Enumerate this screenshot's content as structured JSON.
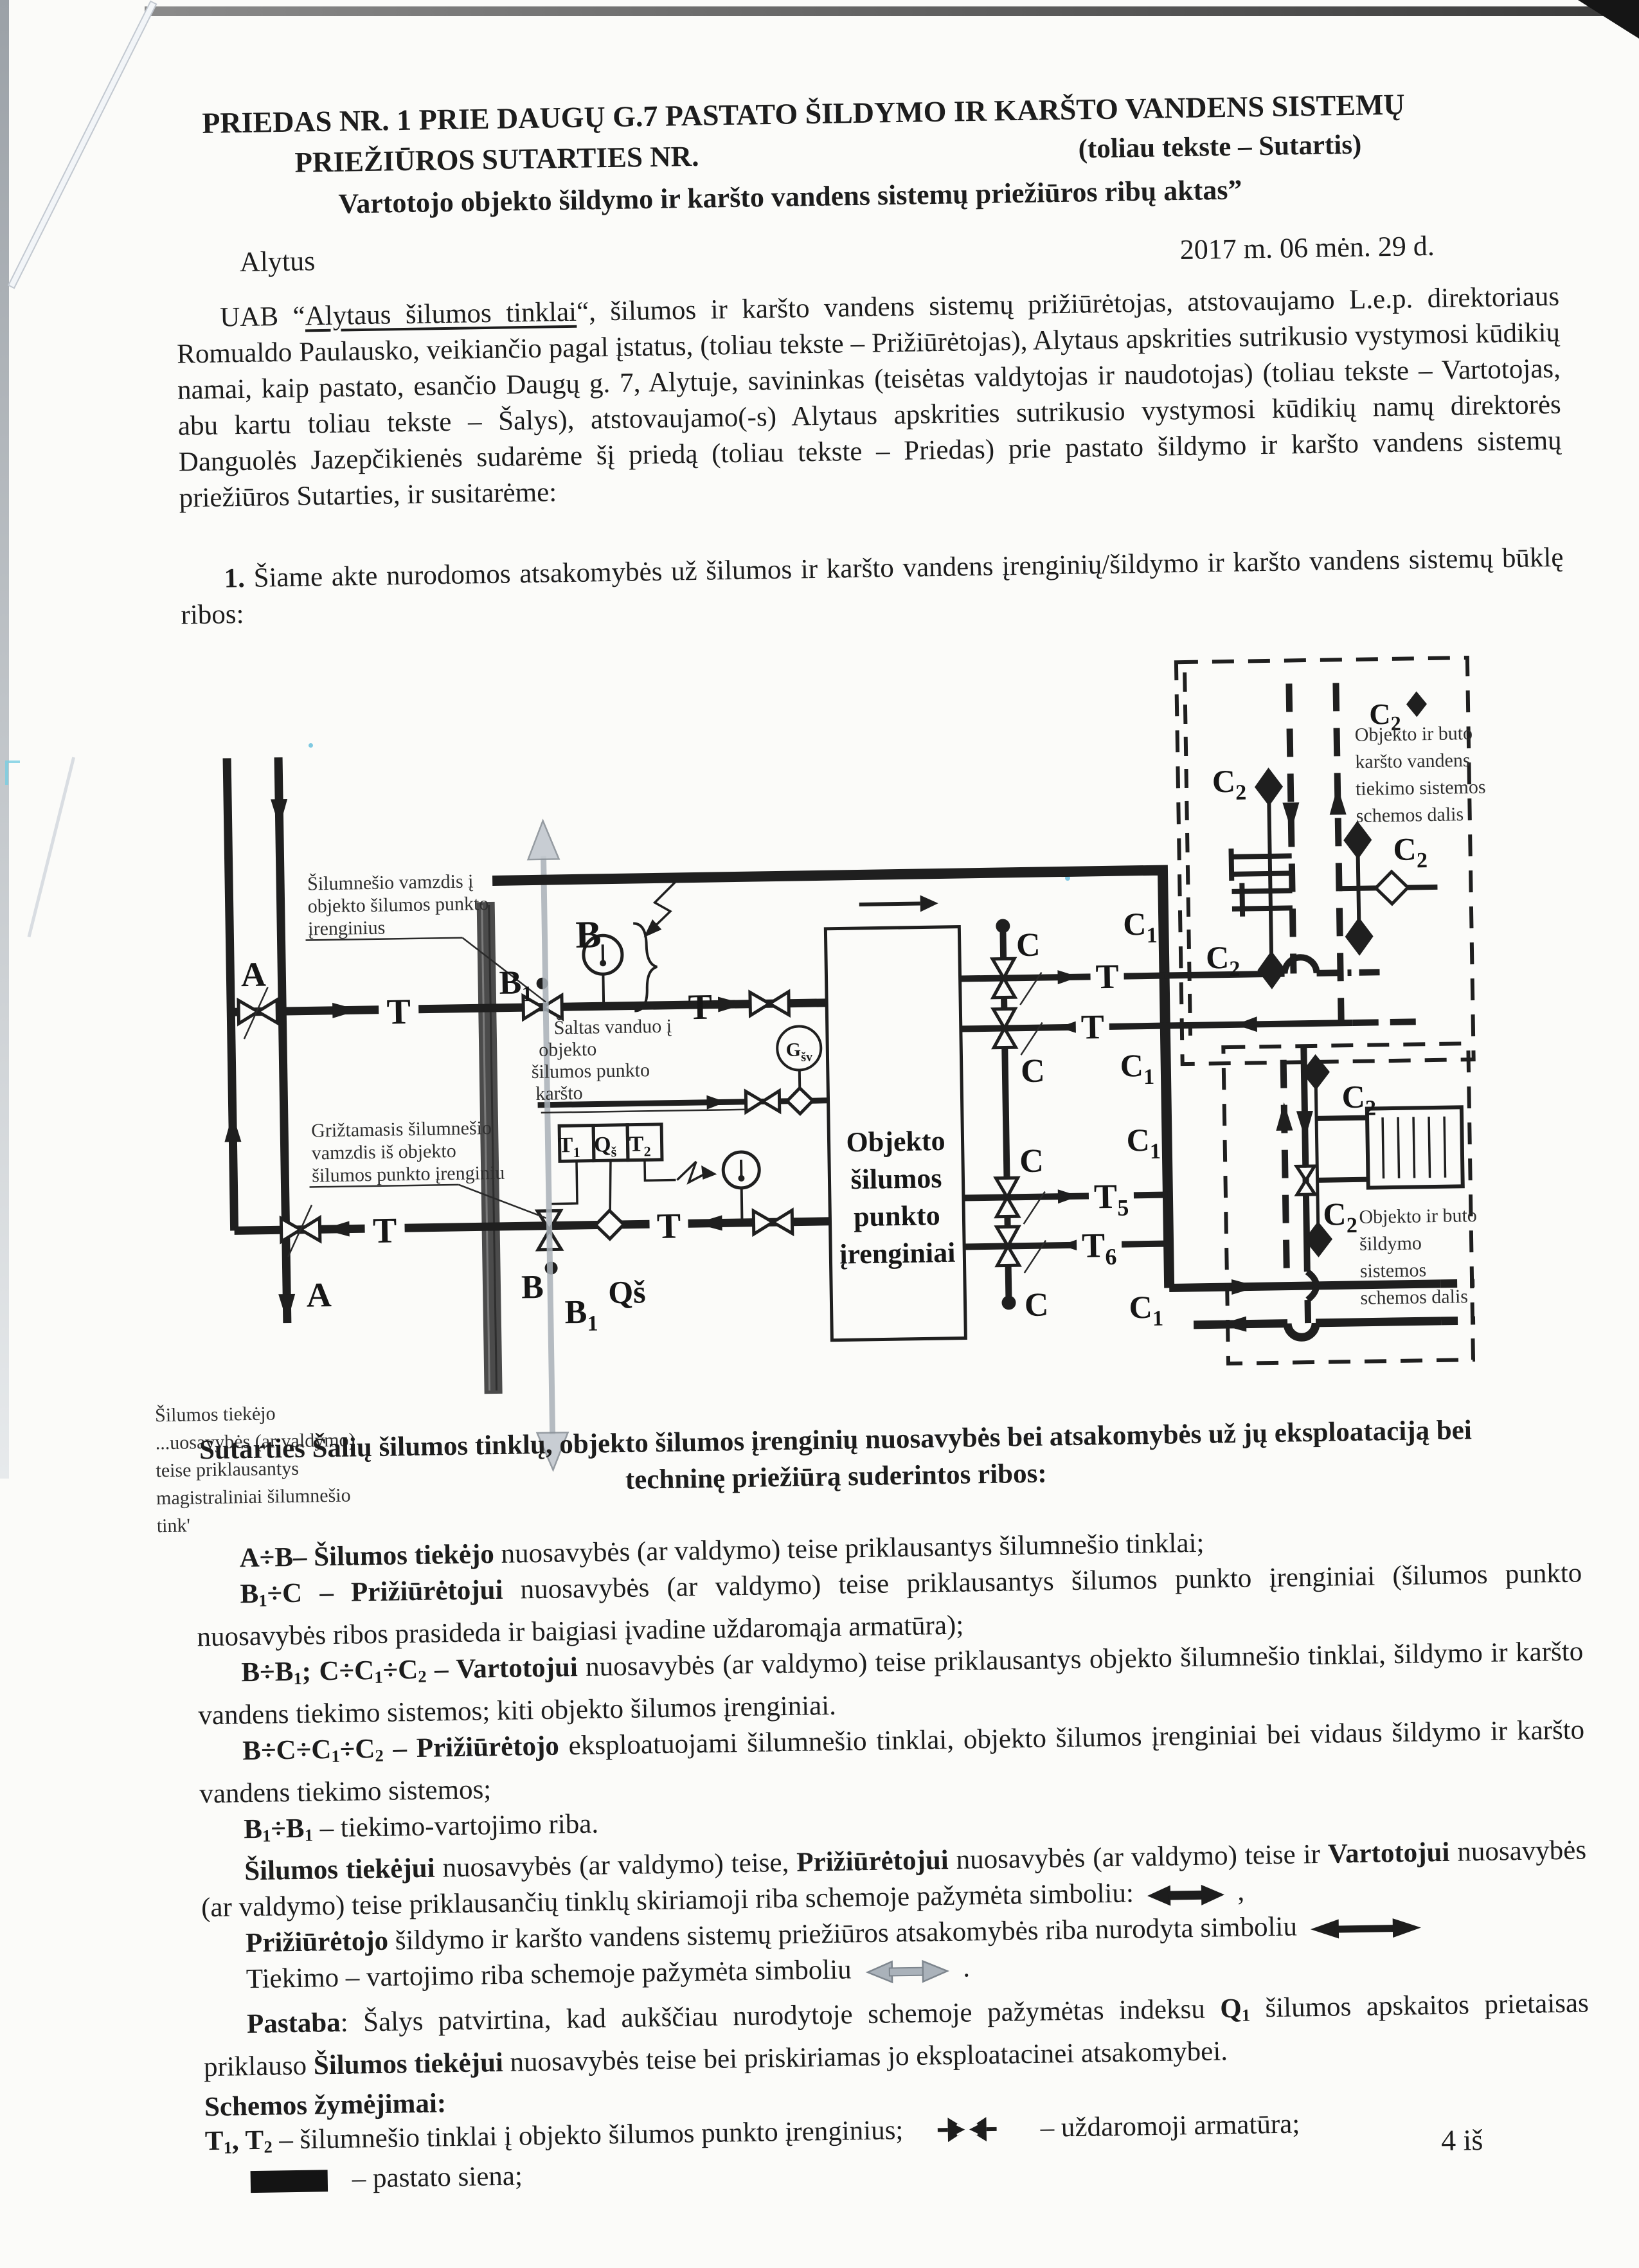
{
  "header": {
    "title1": "PRIEDAS NR. 1 PRIE DAUGŲ G.7  PASTATO ŠILDYMO IR KARŠTO VANDENS SISTEMŲ",
    "title2": "PRIEŽIŪROS SUTARTIES NR.",
    "title2_right": "(toliau tekste – Sutartis)",
    "title3": "Vartotojo objekto šildymo ir karšto vandens sistemų priežiūros ribų aktas”",
    "city": "Alytus",
    "date": "2017 m. 06 mėn. 29 d."
  },
  "intro": [
    {
      "t": "UAB “"
    },
    {
      "t": "Alytaus šilumos tinklai",
      "u": 1
    },
    {
      "t": "“, šilumos ir karšto vandens sistemų prižiūrėtojas, atstovaujamo L.e.p. direktoriaus Romualdo Paulausko, veikiančio pagal įstatus, (toliau tekste – Prižiūrėtojas), Alytaus apskrities sutrikusio vystymosi kūdikių namai, kaip pastato, esančio Daugų g. 7,  Alytuje, savininkas (teisėtas valdytojas ir naudotojas) (toliau tekste – Vartotojas, abu kartu toliau tekste – Šalys), atstovaujamo(-s) Alytaus apskrities sutrikusio vystymosi kūdikių namų direktorės Danguolės Jazepčikienės sudarėme  šį priedą  (toliau tekste – Priedas) prie pastato šildymo ir karšto vandens sistemų priežiūros Sutarties, ir susitarėme:"
    }
  ],
  "point1": [
    {
      "t": "1.",
      "b": 1
    },
    {
      "t": " Šiame akte  nurodomos atsakomybės už šilumos ir karšto vandens įrenginių/šildymo ir karšto vandens sistemų būklę ribos:"
    }
  ],
  "section_heading": "Sutarties Šalių šilumos tinklų, objekto šilumos įrenginių nuosavybės bei atsakomybės už jų eksploataciją bei techninę priežiūrą suderintos ribos:",
  "legend": {
    "item1": [
      {
        "t": "A÷B– Šilumos tiekėjo ",
        "b": 1
      },
      {
        "t": "nuosavybės (ar valdymo) teise priklausantys šilumnešio tinklai;"
      }
    ],
    "item2": [
      {
        "t": "B",
        "b": 1
      },
      {
        "t": "1",
        "b": 1,
        "s": 1
      },
      {
        "t": "÷C – Prižiūrėtojui ",
        "b": 1
      },
      {
        "t": "nuosavybės (ar valdymo) teise priklausantys šilumos punkto įrenginiai (šilumos punkto nuosavybės ribos prasideda ir baigiasi įvadine uždaromąja armatūra);"
      }
    ],
    "item3": [
      {
        "t": "B÷B",
        "b": 1
      },
      {
        "t": "1",
        "b": 1,
        "s": 1
      },
      {
        "t": ";  C÷C",
        "b": 1
      },
      {
        "t": "1",
        "b": 1,
        "s": 1
      },
      {
        "t": "÷C",
        "b": 1
      },
      {
        "t": "2",
        "b": 1,
        "s": 1
      },
      {
        "t": " – Vartotojui ",
        "b": 1
      },
      {
        "t": "nuosavybės (ar valdymo) teise priklausantys objekto šilumnešio tinklai, šildymo ir karšto vandens tiekimo sistemos; kiti objekto šilumos įrenginiai."
      }
    ],
    "item4": [
      {
        "t": "B÷C÷C",
        "b": 1
      },
      {
        "t": "1",
        "b": 1,
        "s": 1
      },
      {
        "t": "÷C",
        "b": 1
      },
      {
        "t": "2",
        "b": 1,
        "s": 1
      },
      {
        "t": " – Prižiūrėtojo ",
        "b": 1
      },
      {
        "t": "eksploatuojami šilumnešio tinklai, objekto šilumos įrenginiai bei vidaus šildymo ir karšto vandens tiekimo sistemos;"
      }
    ],
    "item5": [
      {
        "t": "B",
        "b": 1
      },
      {
        "t": "1",
        "b": 1,
        "s": 1
      },
      {
        "t": "÷B",
        "b": 1
      },
      {
        "t": "1",
        "b": 1,
        "s": 1
      },
      {
        "t": " – tiekimo-vartojimo riba."
      }
    ],
    "item6": [
      {
        "t": "Šilumos tiekėjui ",
        "b": 1
      },
      {
        "t": "nuosavybės (ar valdymo) teise, "
      },
      {
        "t": "Prižiūrėtojui ",
        "b": 1
      },
      {
        "t": "nuosavybės (ar valdymo) teise ir "
      },
      {
        "t": "Vartotojui ",
        "b": 1
      },
      {
        "t": "nuosavybės (ar valdymo) teise priklausančių tinklų skiriamoji riba schemoje pažymėta simboliu: "
      },
      {
        "sym": "own"
      },
      {
        "t": " ,"
      }
    ],
    "item7": [
      {
        "t": "Prižiūrėtojo ",
        "b": 1
      },
      {
        "t": "šildymo ir karšto vandens sistemų priežiūros atsakomybės riba nurodyta simboliu "
      },
      {
        "sym": "maint"
      }
    ],
    "item8": [
      {
        "t": "Tiekimo – vartojimo riba schemoje pažymėta simboliu "
      },
      {
        "sym": "use"
      },
      {
        "t": " ."
      }
    ]
  },
  "pastaba": [
    {
      "t": "Pastaba",
      "b": 1
    },
    {
      "t": ": Šalys patvirtina, kad aukščiau nurodytoje schemoje pažymėtas indeksu "
    },
    {
      "t": "Q",
      "b": 1
    },
    {
      "t": "1",
      "b": 1,
      "s": 1
    },
    {
      "t": " šilumos apskaitos prietaisas priklauso  "
    },
    {
      "t": "Šilumos tiekėjui ",
      "b": 1
    },
    {
      "t": "nuosavybės teise bei priskiriamas jo eksploatacinei atsakomybei."
    }
  ],
  "symbols_section": {
    "title": "Schemos žymėjimai:",
    "line1_left": [
      {
        "t": "T",
        "b": 1
      },
      {
        "t": "1",
        "b": 1,
        "s": 1
      },
      {
        "t": ",  T",
        "b": 1
      },
      {
        "t": "2",
        "b": 1,
        "s": 1
      },
      {
        "t": " – šilumnešio tinklai į objekto šilumos punkto įrenginius;"
      }
    ],
    "line1_right": "– uždaromoji armatūra;",
    "line2_right": "– pastato siena;"
  },
  "page_number": "4 iš",
  "icons": {
    "valve": "bowtie-valve",
    "wall": "filled-black-rectangle",
    "ownership_boundary": "thick-double-headed-arrow",
    "maintenance_boundary": "long-double-headed-arrow",
    "supply_use_boundary": "gray-double-headed-arrow"
  },
  "diagram": {
    "labels": {
      "A": "A",
      "B": "B",
      "B1m": "B",
      "B1s": "1",
      "T": "T",
      "T5m": "T",
      "T5s": "5",
      "T6m": "T",
      "T6s": "6",
      "C": "C",
      "C1m": "C",
      "C1s": "1",
      "C2m": "C",
      "C2s": "2",
      "Qs": "Qš",
      "Gm": "G",
      "Gs": "šv",
      "T1m": "T",
      "T1s": "1",
      "T2m": "T",
      "T2s": "2",
      "QsBm": "Q",
      "QsBs": "š"
    },
    "equipment_box": [
      "Objekto",
      "šilumos",
      "punkto",
      "įrenginiai"
    ],
    "ann_supply": [
      "Šilumnešio vamzdis į",
      "objekto šilumos punkto",
      "įrenginius"
    ],
    "ann_return": [
      "Grižtamasis šilumnešio",
      "vamzdis iš objekto",
      "šilumos punkto įrenginiu"
    ],
    "ann_cold": [
      "Šaltas vanduo į",
      "objekto",
      "šilumos punkto",
      "karšto"
    ],
    "ann_supplier": [
      "Šilumos tiekėjo",
      "...uosavybės (ar valdymo)",
      "teise priklausantys",
      "magistraliniai šilumnešio",
      "tink'"
    ],
    "box_hot": [
      "Objekto ir buto",
      "karšto vandens",
      "tiekimo sistemos",
      "schemos dalis"
    ],
    "box_heat": [
      "Objekto ir buto",
      "šildymo",
      "sistemos",
      "schemos dalis"
    ]
  }
}
